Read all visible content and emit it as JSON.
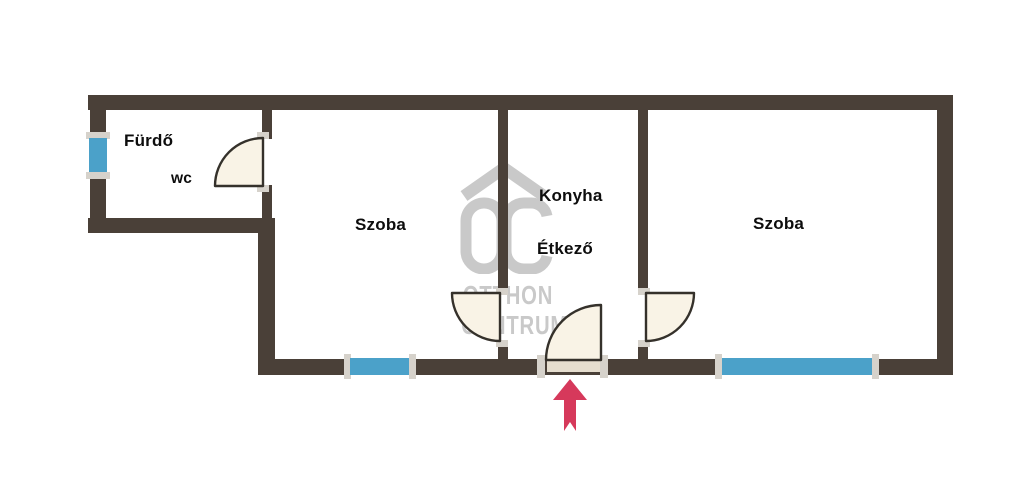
{
  "colors": {
    "wall": "#4a4038",
    "window": "#4ba1c9",
    "door_fill": "#f9f3e6",
    "door_stroke": "#35312b",
    "door_panel": "#e6decf",
    "arrow": "#d6395b",
    "watermark": "#c9c9c9",
    "trim": "#d6d2cb"
  },
  "rooms": [
    {
      "id": "furdo",
      "label": "Fürdő"
    },
    {
      "id": "wc",
      "label": "wc"
    },
    {
      "id": "szoba-left",
      "label": "Szoba"
    },
    {
      "id": "konyha",
      "label": "Konyha"
    },
    {
      "id": "etkezo",
      "label": "Étkező"
    },
    {
      "id": "szoba-right",
      "label": "Szoba"
    }
  ],
  "watermark": {
    "logo": "otthon-centrum-oc-logo",
    "line1": "OTTHON",
    "line2": "CENTRUM"
  },
  "icons": {
    "entrance_arrow": "up-arrow"
  }
}
